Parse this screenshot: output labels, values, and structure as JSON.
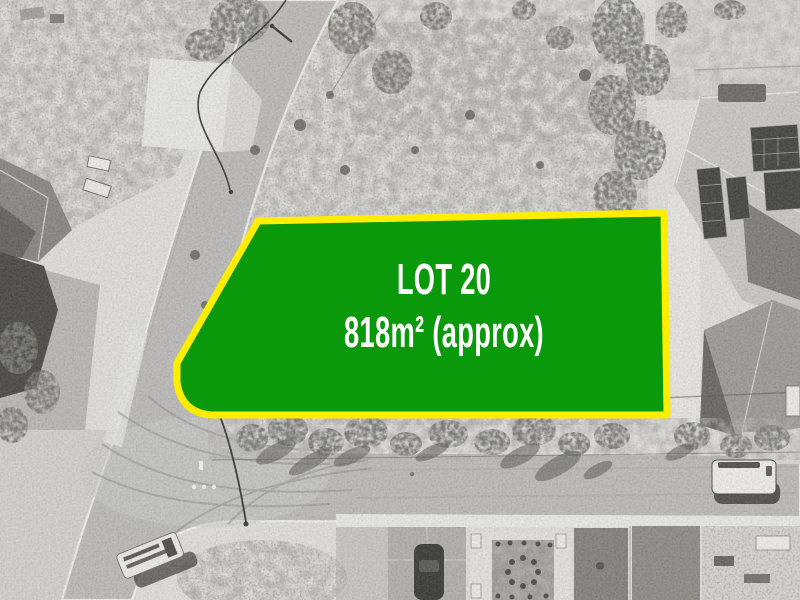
{
  "lot_overlay": {
    "lot_label": "LOT 20",
    "area_label": "818m² (approx)",
    "fill_color": "#0a990a",
    "border_color": "#ffed00",
    "border_width": 7,
    "text_color": "#ffffff"
  },
  "scene": {
    "style": "black-and-white aerial photograph of a residential land estate"
  }
}
